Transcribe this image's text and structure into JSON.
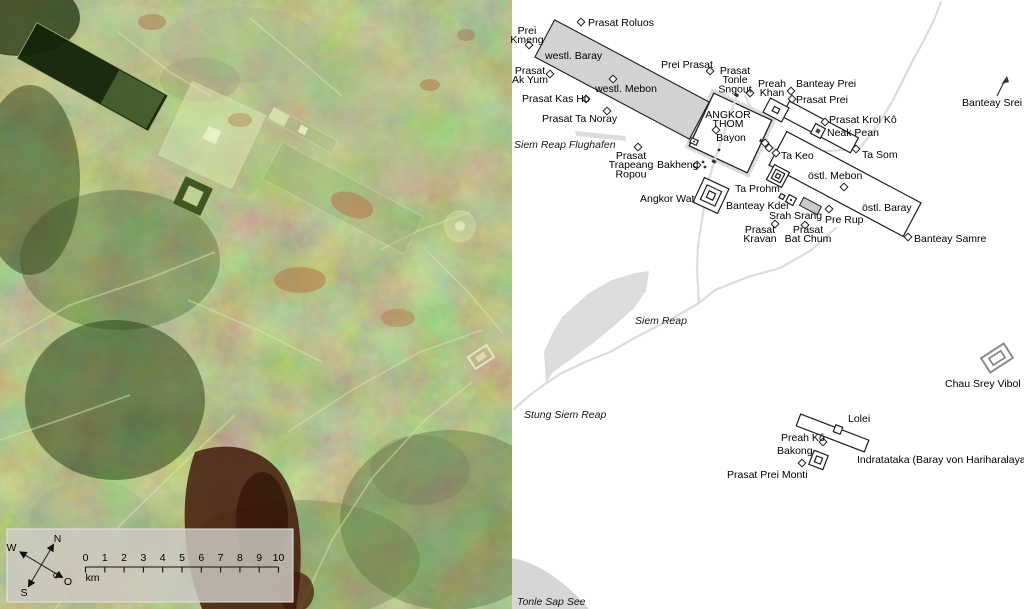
{
  "satellite": {
    "description_name": "radar-satellite-image-of-angkor",
    "overlay": {
      "compass": {
        "north": "N",
        "south": "S",
        "west": "W",
        "east": "O"
      },
      "scale_ticks": [
        "0",
        "1",
        "2",
        "3",
        "4",
        "5",
        "6",
        "7",
        "8",
        "9",
        "10"
      ],
      "scale_unit": "km"
    },
    "colors": {
      "base_green": "#76885c",
      "dark_baray_water": "#14240a",
      "bright_enclosure": "#d9e6ad",
      "red_soil": "#3f1507",
      "overlay_box": "#cdc9c2"
    }
  },
  "map": {
    "colors": {
      "map_background": "#ffffff",
      "outline": "#1f1f1f",
      "road": "#dcdcdc",
      "baray_fill": "#d2d2d2",
      "srah_srang_fill": "#c9c9c9",
      "water_fill": "#d6d6d6",
      "vibol_gray": "#8a8a8a",
      "label_color": "#000000"
    },
    "line_height": 9.2,
    "labels": [
      {
        "id": "prasat-roluos",
        "lines": [
          "Prasat Roluos"
        ],
        "x": 588,
        "y": 26,
        "anchor": "start"
      },
      {
        "id": "prei-kmeng",
        "lines": [
          "Prei",
          "Kmeng"
        ],
        "x": 527,
        "y": 34,
        "anchor": "middle"
      },
      {
        "id": "westl-baray",
        "lines": [
          "westl. Baray"
        ],
        "x": 545,
        "y": 59,
        "anchor": "start"
      },
      {
        "id": "prasat-ak-yum",
        "lines": [
          "Prasat",
          "Ak Yum"
        ],
        "x": 530,
        "y": 74,
        "anchor": "middle"
      },
      {
        "id": "westl-mebon",
        "lines": [
          "westl. Mebon"
        ],
        "x": 626,
        "y": 92,
        "anchor": "middle"
      },
      {
        "id": "prasat-kas-ho",
        "lines": [
          "Prasat Kas Ho"
        ],
        "x": 522,
        "y": 102,
        "anchor": "start"
      },
      {
        "id": "prasat-ta-noray",
        "lines": [
          "Prasat Ta Noray"
        ],
        "x": 542,
        "y": 122,
        "anchor": "start"
      },
      {
        "id": "prei-prasat",
        "lines": [
          "Prei Prasat"
        ],
        "x": 661,
        "y": 68,
        "anchor": "start"
      },
      {
        "id": "prasat-tonle-sngout",
        "lines": [
          "Prasat",
          "Tonle",
          "Sngout"
        ],
        "x": 735,
        "y": 74,
        "anchor": "middle"
      },
      {
        "id": "preah-khan",
        "lines": [
          "Preah",
          "Khan"
        ],
        "x": 772,
        "y": 87,
        "anchor": "middle"
      },
      {
        "id": "banteay-prei",
        "lines": [
          "Banteay Prei"
        ],
        "x": 796,
        "y": 87,
        "anchor": "start"
      },
      {
        "id": "prasat-prei",
        "lines": [
          "Prasat Prei"
        ],
        "x": 796,
        "y": 103,
        "anchor": "start"
      },
      {
        "id": "prasat-krol-ko",
        "lines": [
          "Prasat Krol Kô"
        ],
        "x": 829,
        "y": 123,
        "anchor": "start"
      },
      {
        "id": "neak-pean",
        "lines": [
          "Neak Pean"
        ],
        "x": 827,
        "y": 136,
        "anchor": "start"
      },
      {
        "id": "ta-som",
        "lines": [
          "Ta Som"
        ],
        "x": 862,
        "y": 158,
        "anchor": "start"
      },
      {
        "id": "banteay-srei",
        "lines": [
          "Banteay Srei"
        ],
        "x": 962,
        "y": 106,
        "anchor": "start"
      },
      {
        "id": "angkor-thom",
        "lines": [
          "ANGKOR",
          "THOM"
        ],
        "x": 728,
        "y": 118,
        "anchor": "middle"
      },
      {
        "id": "bayon",
        "lines": [
          "Bayon"
        ],
        "x": 731,
        "y": 141,
        "anchor": "middle"
      },
      {
        "id": "ta-keo",
        "lines": [
          "Ta Keo"
        ],
        "x": 781,
        "y": 159,
        "anchor": "start"
      },
      {
        "id": "ta-prohm",
        "lines": [
          "Ta Prohm"
        ],
        "x": 735,
        "y": 192,
        "anchor": "start"
      },
      {
        "id": "ostl-mebon",
        "lines": [
          "östl. Mebon"
        ],
        "x": 808,
        "y": 179,
        "anchor": "start"
      },
      {
        "id": "banteay-kdei",
        "lines": [
          "Banteay Kdei"
        ],
        "x": 726,
        "y": 209,
        "anchor": "start"
      },
      {
        "id": "srah-srang",
        "lines": [
          "Srah Srang"
        ],
        "x": 769,
        "y": 219,
        "anchor": "start"
      },
      {
        "id": "pre-rup",
        "lines": [
          "Pre Rup"
        ],
        "x": 825,
        "y": 223,
        "anchor": "start"
      },
      {
        "id": "ostl-baray",
        "lines": [
          "östl. Baray"
        ],
        "x": 862,
        "y": 211,
        "anchor": "start"
      },
      {
        "id": "prasat-kravan",
        "lines": [
          "Prasat",
          "Kravan"
        ],
        "x": 760,
        "y": 233,
        "anchor": "middle"
      },
      {
        "id": "prasat-bat-chum",
        "lines": [
          "Prasat",
          "Bat Chum"
        ],
        "x": 808,
        "y": 233,
        "anchor": "middle"
      },
      {
        "id": "banteay-samre",
        "lines": [
          "Banteay Samre"
        ],
        "x": 914,
        "y": 242,
        "anchor": "start"
      },
      {
        "id": "bakheng",
        "lines": [
          "Bakheng"
        ],
        "x": 657,
        "y": 168,
        "anchor": "start"
      },
      {
        "id": "prasat-trapeang-ropou",
        "lines": [
          "Prasat",
          "Trapeang",
          "Ropou"
        ],
        "x": 631,
        "y": 159,
        "anchor": "middle"
      },
      {
        "id": "angkor-wat",
        "lines": [
          "Angkor Wat"
        ],
        "x": 640,
        "y": 202,
        "anchor": "start"
      },
      {
        "id": "siem-reap-flughafen",
        "lines": [
          "Siem Reap Flughafen"
        ],
        "x": 514,
        "y": 148,
        "anchor": "start",
        "italic": true
      },
      {
        "id": "siem-reap",
        "lines": [
          "Siem Reap"
        ],
        "x": 635,
        "y": 324,
        "anchor": "start",
        "italic": true
      },
      {
        "id": "stung-siem-reap",
        "lines": [
          "Stung Siem Reap"
        ],
        "x": 524,
        "y": 418,
        "anchor": "start",
        "italic": true
      },
      {
        "id": "tonle-sap-see",
        "lines": [
          "Tonle Sap See"
        ],
        "x": 517,
        "y": 605,
        "anchor": "start",
        "italic": true
      },
      {
        "id": "lolei",
        "lines": [
          "Lolei"
        ],
        "x": 848,
        "y": 422,
        "anchor": "start"
      },
      {
        "id": "preah-ko",
        "lines": [
          "Preah Kô"
        ],
        "x": 781,
        "y": 441,
        "anchor": "start"
      },
      {
        "id": "bakong",
        "lines": [
          "Bakong"
        ],
        "x": 777,
        "y": 454,
        "anchor": "start"
      },
      {
        "id": "prasat-prei-monti",
        "lines": [
          "Prasat Prei Monti"
        ],
        "x": 727,
        "y": 478,
        "anchor": "start"
      },
      {
        "id": "indratataka",
        "lines": [
          "Indratataka (Baray von Hariharalaya)"
        ],
        "x": 857,
        "y": 463,
        "anchor": "start"
      },
      {
        "id": "chau-srey-vibol",
        "lines": [
          "Chau Srey Vibol"
        ],
        "x": 945,
        "y": 387,
        "anchor": "start"
      }
    ],
    "markers": [
      {
        "id": "prasat-roluos",
        "x": 581,
        "y": 22
      },
      {
        "id": "prei-kmeng",
        "x": 529,
        "y": 45
      },
      {
        "id": "prasat-ak-yum",
        "x": 550,
        "y": 74
      },
      {
        "id": "westl-mebon",
        "x": 613,
        "y": 79
      },
      {
        "id": "prasat-kas-ho",
        "x": 586,
        "y": 99
      },
      {
        "id": "prasat-ta-noray",
        "x": 607,
        "y": 111
      },
      {
        "id": "prei-prasat",
        "x": 710,
        "y": 71
      },
      {
        "id": "prasat-tonle-sngout",
        "x": 750,
        "y": 93
      },
      {
        "id": "banteay-prei",
        "x": 791,
        "y": 91
      },
      {
        "id": "prasat-prei",
        "x": 792,
        "y": 99
      },
      {
        "id": "prasat-krol-ko",
        "x": 825,
        "y": 122
      },
      {
        "id": "ta-som",
        "x": 856,
        "y": 149
      },
      {
        "id": "ta-keo",
        "x": 776,
        "y": 153
      },
      {
        "id": "ostl-mebon",
        "x": 844,
        "y": 187
      },
      {
        "id": "pre-rup",
        "x": 829,
        "y": 209
      },
      {
        "id": "prasat-kravan",
        "x": 775,
        "y": 224
      },
      {
        "id": "prasat-bat-chum",
        "x": 805,
        "y": 225
      },
      {
        "id": "banteay-samre",
        "x": 908,
        "y": 237
      },
      {
        "id": "bakheng",
        "x": 697,
        "y": 165
      },
      {
        "id": "prasat-trapeang-ropou",
        "x": 638,
        "y": 147
      },
      {
        "id": "preah-ko",
        "x": 823,
        "y": 442
      },
      {
        "id": "prasat-prei-monti",
        "x": 802,
        "y": 463
      },
      {
        "id": "bayon",
        "x": 716,
        "y": 130
      },
      {
        "id": "small-temple-east-1",
        "x": 765,
        "y": 143
      },
      {
        "id": "small-temple-east-2",
        "x": 769,
        "y": 148
      },
      {
        "id": "bakheng-dot-1",
        "type": "dot",
        "x": 703,
        "y": 162
      },
      {
        "id": "bakheng-dot-2",
        "type": "dot",
        "x": 705,
        "y": 167
      },
      {
        "id": "bayon-dot",
        "type": "dot",
        "x": 719,
        "y": 150
      }
    ]
  }
}
